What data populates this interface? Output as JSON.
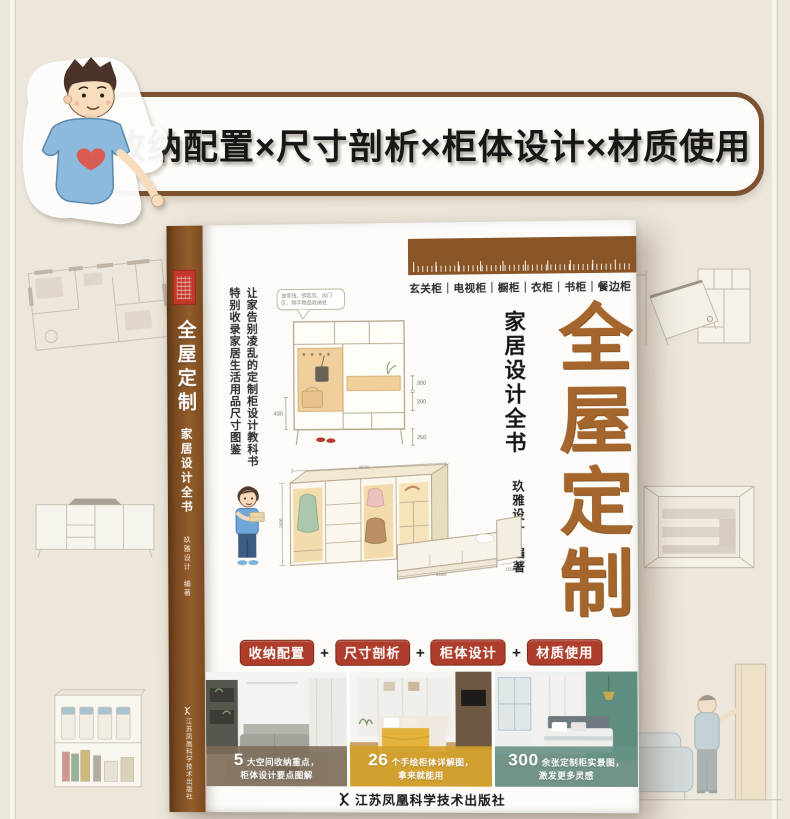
{
  "banner": {
    "text": "收纳配置×尺寸剖析×柜体设计×材质使用"
  },
  "book": {
    "spine": {
      "title": "全屋定制",
      "subtitle": "家居设计全书",
      "author_name": "玖雅设计",
      "author_role": "编著",
      "publisher": "江苏凤凰科学技术出版社"
    },
    "cover": {
      "categories": "玄关柜｜电视柜｜橱柜｜衣柜｜书柜｜餐边柜",
      "title": "全屋定制",
      "subtitle": "家居设计全书",
      "author_name": "玖雅设计",
      "author_role": "编著",
      "tagline_right": "让家告别凌乱的定制柜设计教科书",
      "tagline_left": "特别收录家居生活用品尺寸图鉴",
      "bubble_line1": "放零钱、钥匙包、出门",
      "bubble_line2": "区，随手物品收纳处",
      "badge_plus": "+",
      "badges": [
        "收纳配置",
        "尺寸剖析",
        "柜体设计",
        "材质使用"
      ],
      "stats": [
        {
          "number": "5",
          "line1": "大空间收纳重点，",
          "line2": "柜体设计要点图解"
        },
        {
          "number": "26",
          "line1": "个手绘柜体详解图，",
          "line2": "拿来就能用"
        },
        {
          "number": "300",
          "line1": "余张定制柜实景图，",
          "line2": "激发更多灵感"
        }
      ],
      "publisher": "江苏凤凰科学技术出版社",
      "entry_dims": {
        "d300": "300",
        "d200": "200",
        "d250": "250",
        "d430": "430"
      },
      "wardrobe_dims": {
        "top": "2670",
        "left": "2400",
        "bottom": "2180",
        "bed": "1500"
      }
    }
  },
  "colors": {
    "background": "#ece6db",
    "banner_border": "#7d5230",
    "spine_brown": "#8a5526",
    "title_brown": "#a4662c",
    "badge_red": "#ae3e2b",
    "overlay_gray_brown": "#7c6b59",
    "overlay_yellow": "#d3a029",
    "overlay_teal": "#679186"
  },
  "icons": {
    "publisher_logo": "phoenix",
    "banner_mascot": "man-with-heart-shirt"
  }
}
